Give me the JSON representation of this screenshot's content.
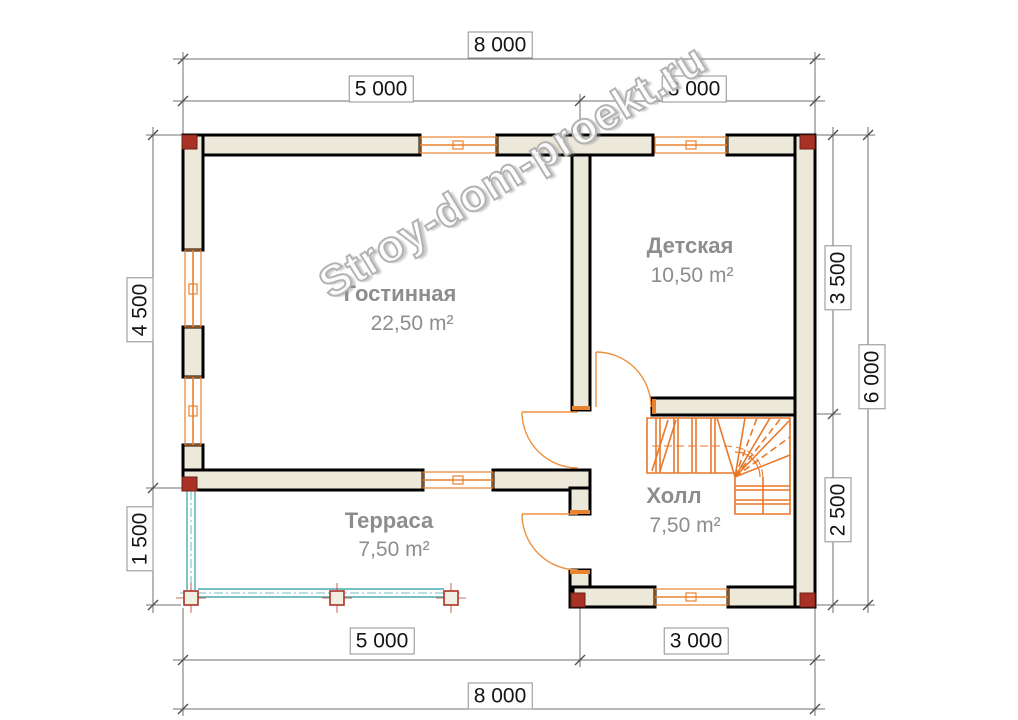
{
  "watermark": "Stroy-dom-proekt.ru",
  "rooms": {
    "living": {
      "name": "Гостинная",
      "area": "22,50 m²"
    },
    "kids": {
      "name": "Детская",
      "area": "10,50 m²"
    },
    "hall": {
      "name": "Холл",
      "area": "7,50 m²"
    },
    "terrace": {
      "name": "Терраса",
      "area": "7,50 m²"
    }
  },
  "dimensions": {
    "top_total": "8 000",
    "top_left": "5 000",
    "top_right": "3 000",
    "left_upper": "4 500",
    "left_lower": "1 500",
    "right_upper": "3 500",
    "right_lower": "2 500",
    "right_total": "6 000",
    "bottom_left": "5 000",
    "bottom_right": "3 000",
    "bottom_total": "8 000"
  },
  "colors": {
    "wall_fill": "#ece8da",
    "wall_stroke": "#000000",
    "window_orange": "#e8822c",
    "door_orange": "#ed9140",
    "stairs_orange": "#e8782a",
    "railing_teal": "#4aa9b2",
    "corner_mark_red": "#a93226",
    "room_text_gray": "#8d8d8d",
    "dimension_gray": "#6f6f6f",
    "watermark_gray": "#b3b3b3"
  }
}
